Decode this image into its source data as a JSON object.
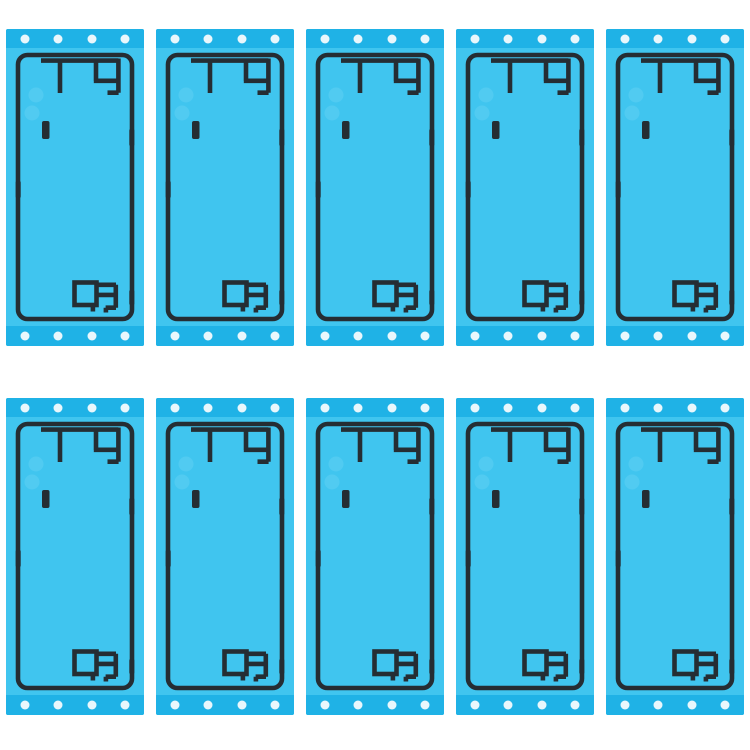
{
  "meta": {
    "description": "Product photo: 10 phone back-cover adhesive sticker sheets on a white background"
  },
  "grid": {
    "rows": 2,
    "columns": 5,
    "total_sheets": 10
  },
  "sheet": {
    "dots_per_band": 4,
    "dot_bands": [
      "top",
      "bottom"
    ],
    "features": [
      "rounded-rectangle-adhesive-outline",
      "camera-cutout-adhesive-top-left",
      "flash-notch",
      "side-alignment-tabs",
      "bottom-right-cutout-adhesive",
      "perforation-dots",
      "highlight-spots"
    ]
  },
  "colors": {
    "background": "#ffffff",
    "sheet_main": "#40c5ef",
    "sheet_band": "#1fb2e6",
    "outline_black": "#252d33",
    "dot_white": "#e9f7fc",
    "highlight_spot": "#62d1f3"
  }
}
